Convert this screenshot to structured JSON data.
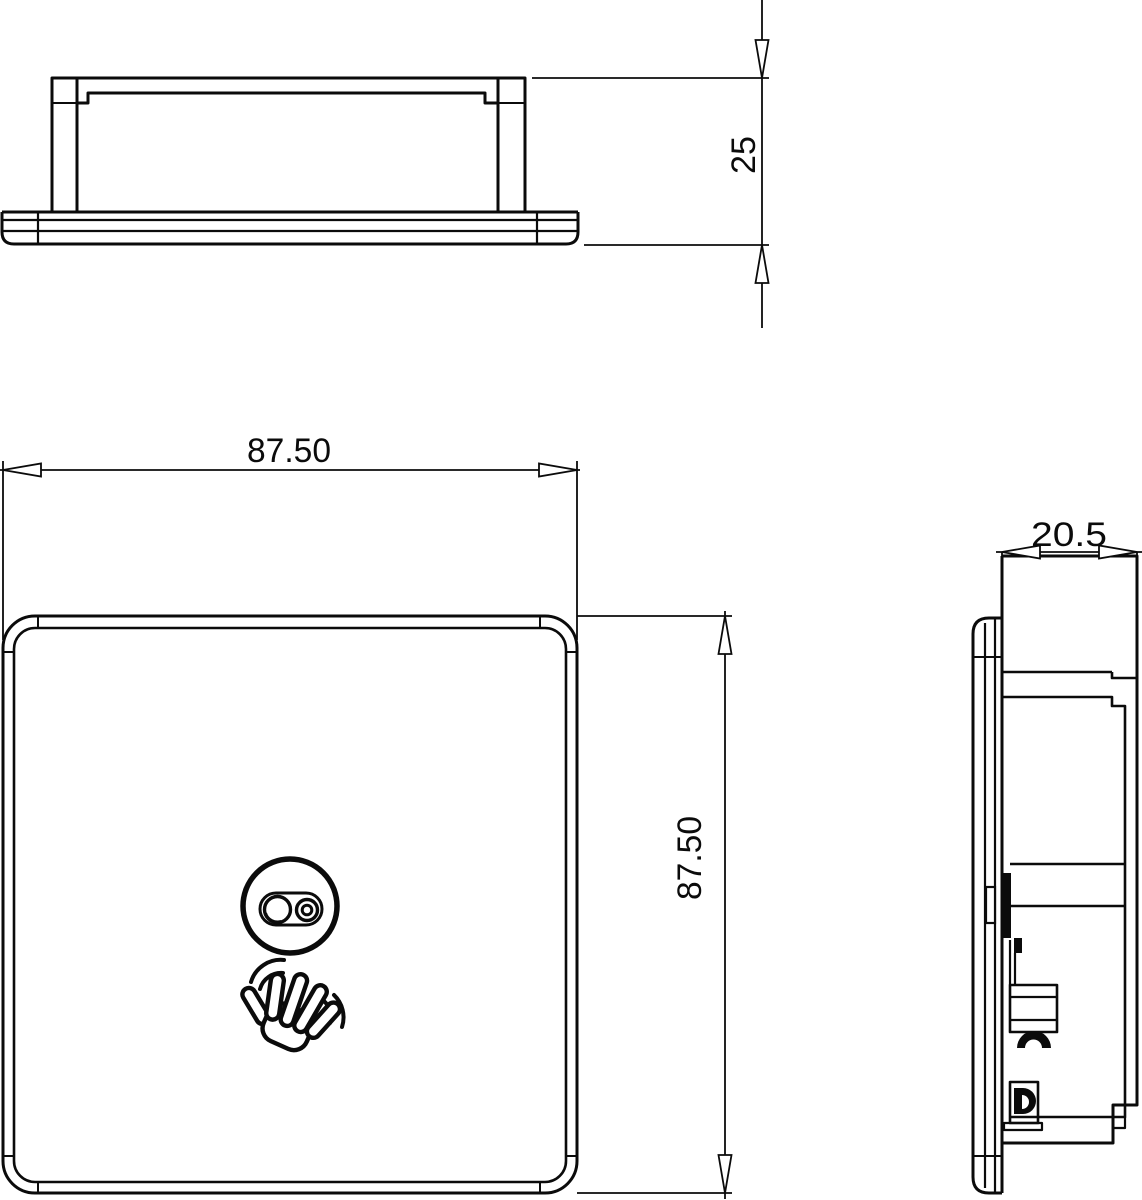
{
  "dimensions": {
    "front_width": "87.50",
    "front_height": "87.50",
    "housing_height": "25",
    "side_depth": "20.5"
  },
  "icons": {
    "sensor": "sensor-window-icon",
    "hand": "waving-hand-icon"
  },
  "colors": {
    "background": "#ffffff",
    "line": "#0b0b0b"
  }
}
